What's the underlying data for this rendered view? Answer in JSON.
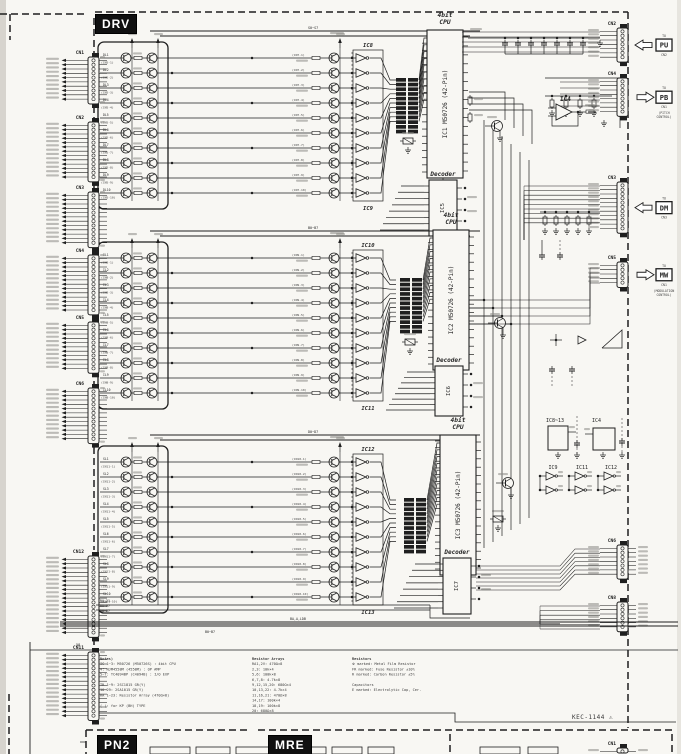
{
  "document": {
    "kind": "scanned driver-board circuit schematic",
    "ref": "KEC-1144",
    "warn_glyph": "⚠",
    "paper": "#f8f7f3",
    "ink": "#1f1f1f"
  },
  "sections": {
    "drv": "DRV",
    "pn2": "PN2",
    "mre": "MRE"
  },
  "cpu_blocks": [
    {
      "cpu_id": "IC1",
      "cpu_type_line1": "4bit",
      "cpu_type_line2": "CPU",
      "cpu_part": "M50726 (42-Pin)",
      "decoder_id": "IC5",
      "decoder_label": "Decoder",
      "inverter_top": "IC8",
      "inverter_bottom": "IC9",
      "rows": 10,
      "row_prefix": "DL",
      "row_connector": "CN5",
      "mid_connector": "CN7",
      "bus_label": "S0~S7"
    },
    {
      "cpu_id": "IC2",
      "cpu_type_line1": "4bit",
      "cpu_type_line2": "CPU",
      "cpu_part": "M50726 (42-Pin)",
      "decoder_id": "IC6",
      "decoder_label": "Decoder",
      "inverter_top": "IC10",
      "inverter_bottom": "IC11",
      "rows": 10,
      "row_prefix": "IL",
      "row_connector": "CN8",
      "mid_connector": "CN9",
      "bus_label": "B0~B7"
    },
    {
      "cpu_id": "IC3",
      "cpu_type_line1": "4bit",
      "cpu_type_line2": "CPU",
      "cpu_part": "M50726 (42-Pin)",
      "decoder_id": "IC7",
      "decoder_label": "Decoder",
      "inverter_top": "IC12",
      "inverter_bottom": "IC13",
      "rows": 10,
      "row_prefix": "SL",
      "row_connector": "CN11",
      "mid_connector": "CN10",
      "bus_label": "D0~D7"
    }
  ],
  "left_connectors": [
    {
      "id": "CN1",
      "pins": 10
    },
    {
      "id": "CN2",
      "pins": 13
    },
    {
      "id": "CN3",
      "pins": 12
    },
    {
      "id": "CN4",
      "pins": 13
    },
    {
      "id": "CN5",
      "pins": 11
    },
    {
      "id": "CN6",
      "pins": 12
    },
    {
      "id": "CN12",
      "pins": 18
    },
    {
      "id": "CN11",
      "pins": 15
    }
  ],
  "right_connectors": [
    {
      "id": "CN2",
      "pins": 7,
      "tag": "PU",
      "arrow": "left",
      "note_top": "TO",
      "note_bottom": "CN2"
    },
    {
      "id": "CN4",
      "pins": 8,
      "tag": "PB",
      "arrow": "right",
      "note_top": "TO",
      "note_bottom": "CN1",
      "note": [
        "(PITCH",
        "CONTROL)"
      ]
    },
    {
      "id": "CN3",
      "pins": 11,
      "tag": "DM",
      "arrow": "left",
      "note_top": "TO",
      "note_bottom": "CN3"
    },
    {
      "id": "CN5",
      "pins": 5,
      "tag": "MW",
      "arrow": "right",
      "note_top": "TO",
      "note_bottom": "CN1",
      "note": [
        "(MODULATION",
        "CONTROL)"
      ]
    },
    {
      "id": "CN6",
      "pins": 7
    },
    {
      "id": "CN8",
      "pins": 6
    },
    {
      "id": "CN1",
      "pins": 3
    }
  ],
  "side_ics": {
    "array_group": "IC8~13",
    "opamp_group": "IC4",
    "opamp": "IC4",
    "buffers": [
      "IC9",
      "IC11",
      "IC12"
    ]
  },
  "bus_labels": {
    "left_stack": [
      "RA,21",
      "B0~B7",
      "D0~D7"
    ],
    "mid": "BA,A,LDB",
    "mid2": "B0~B7",
    "corner": "58"
  },
  "notes": {
    "col1": [
      "Notes)",
      "IC 1~3: M50726 (M50726S) : 4bit CPU",
      "4: NJM4558M (4558M) : OP AMP",
      "5~7: TC4094BP (C4094B) : I/O EXP",
      "",
      "TR 1~9: 2SC1815 GR(Y)",
      "10~29: 2SA1015 GR(Y)",
      "RA 1~23: Resistor Array (470Ω×8)",
      "",
      "( ): for KP (BH) TYPE"
    ],
    "col2": [
      "Resistor Arrays",
      "RA1,2V: 470Ω×8",
      "2,3: 10k×4",
      "5,6: 100k×8",
      "6,7,8: 4.7k×8",
      "9,12,15,20: 680Ω×4",
      "10,13,22: 4.7k×4",
      "11,16,21: 470Ω×8",
      "14,17: 100k×4",
      "18,19: 100k×8",
      "20: 680Ω×8"
    ],
    "col3": [
      "Resistors",
      "※ marked: Metal Film Resistor",
      "FR marked: Fuse Resistor ±10%",
      "R marked: Carbon Resistor ±5%",
      "",
      "Capacitors",
      "E marked: Electrolytic Cap, Cer."
    ]
  }
}
